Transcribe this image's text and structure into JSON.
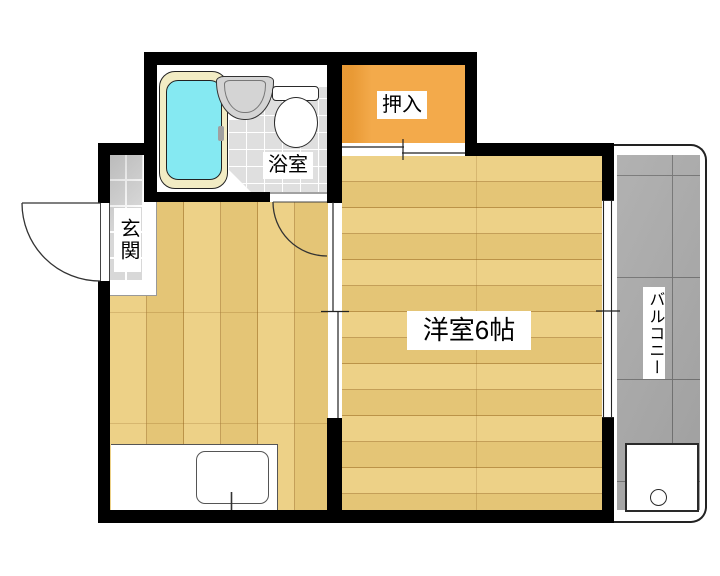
{
  "floorplan": {
    "kind": "Japanese apartment floor plan",
    "labels": {
      "entrance": "玄関",
      "bathroom": "浴室",
      "closet": "押入",
      "western_room": "洋室6帖",
      "balcony": "バルコニー"
    },
    "colors": {
      "wall": "#000000",
      "wood_floor": "#ecce7e",
      "wood_seam": "#9c6c22",
      "closet_fill": "#f2a33c",
      "bathtub_water": "#85e9f2",
      "bathtub_rim": "#f2ecc4",
      "bathroom_tile": "#dfdfdf",
      "entrance_tile": "#d8d8d8",
      "balcony_tile": "#a9a9a9",
      "fixture_white": "#ffffff"
    }
  }
}
